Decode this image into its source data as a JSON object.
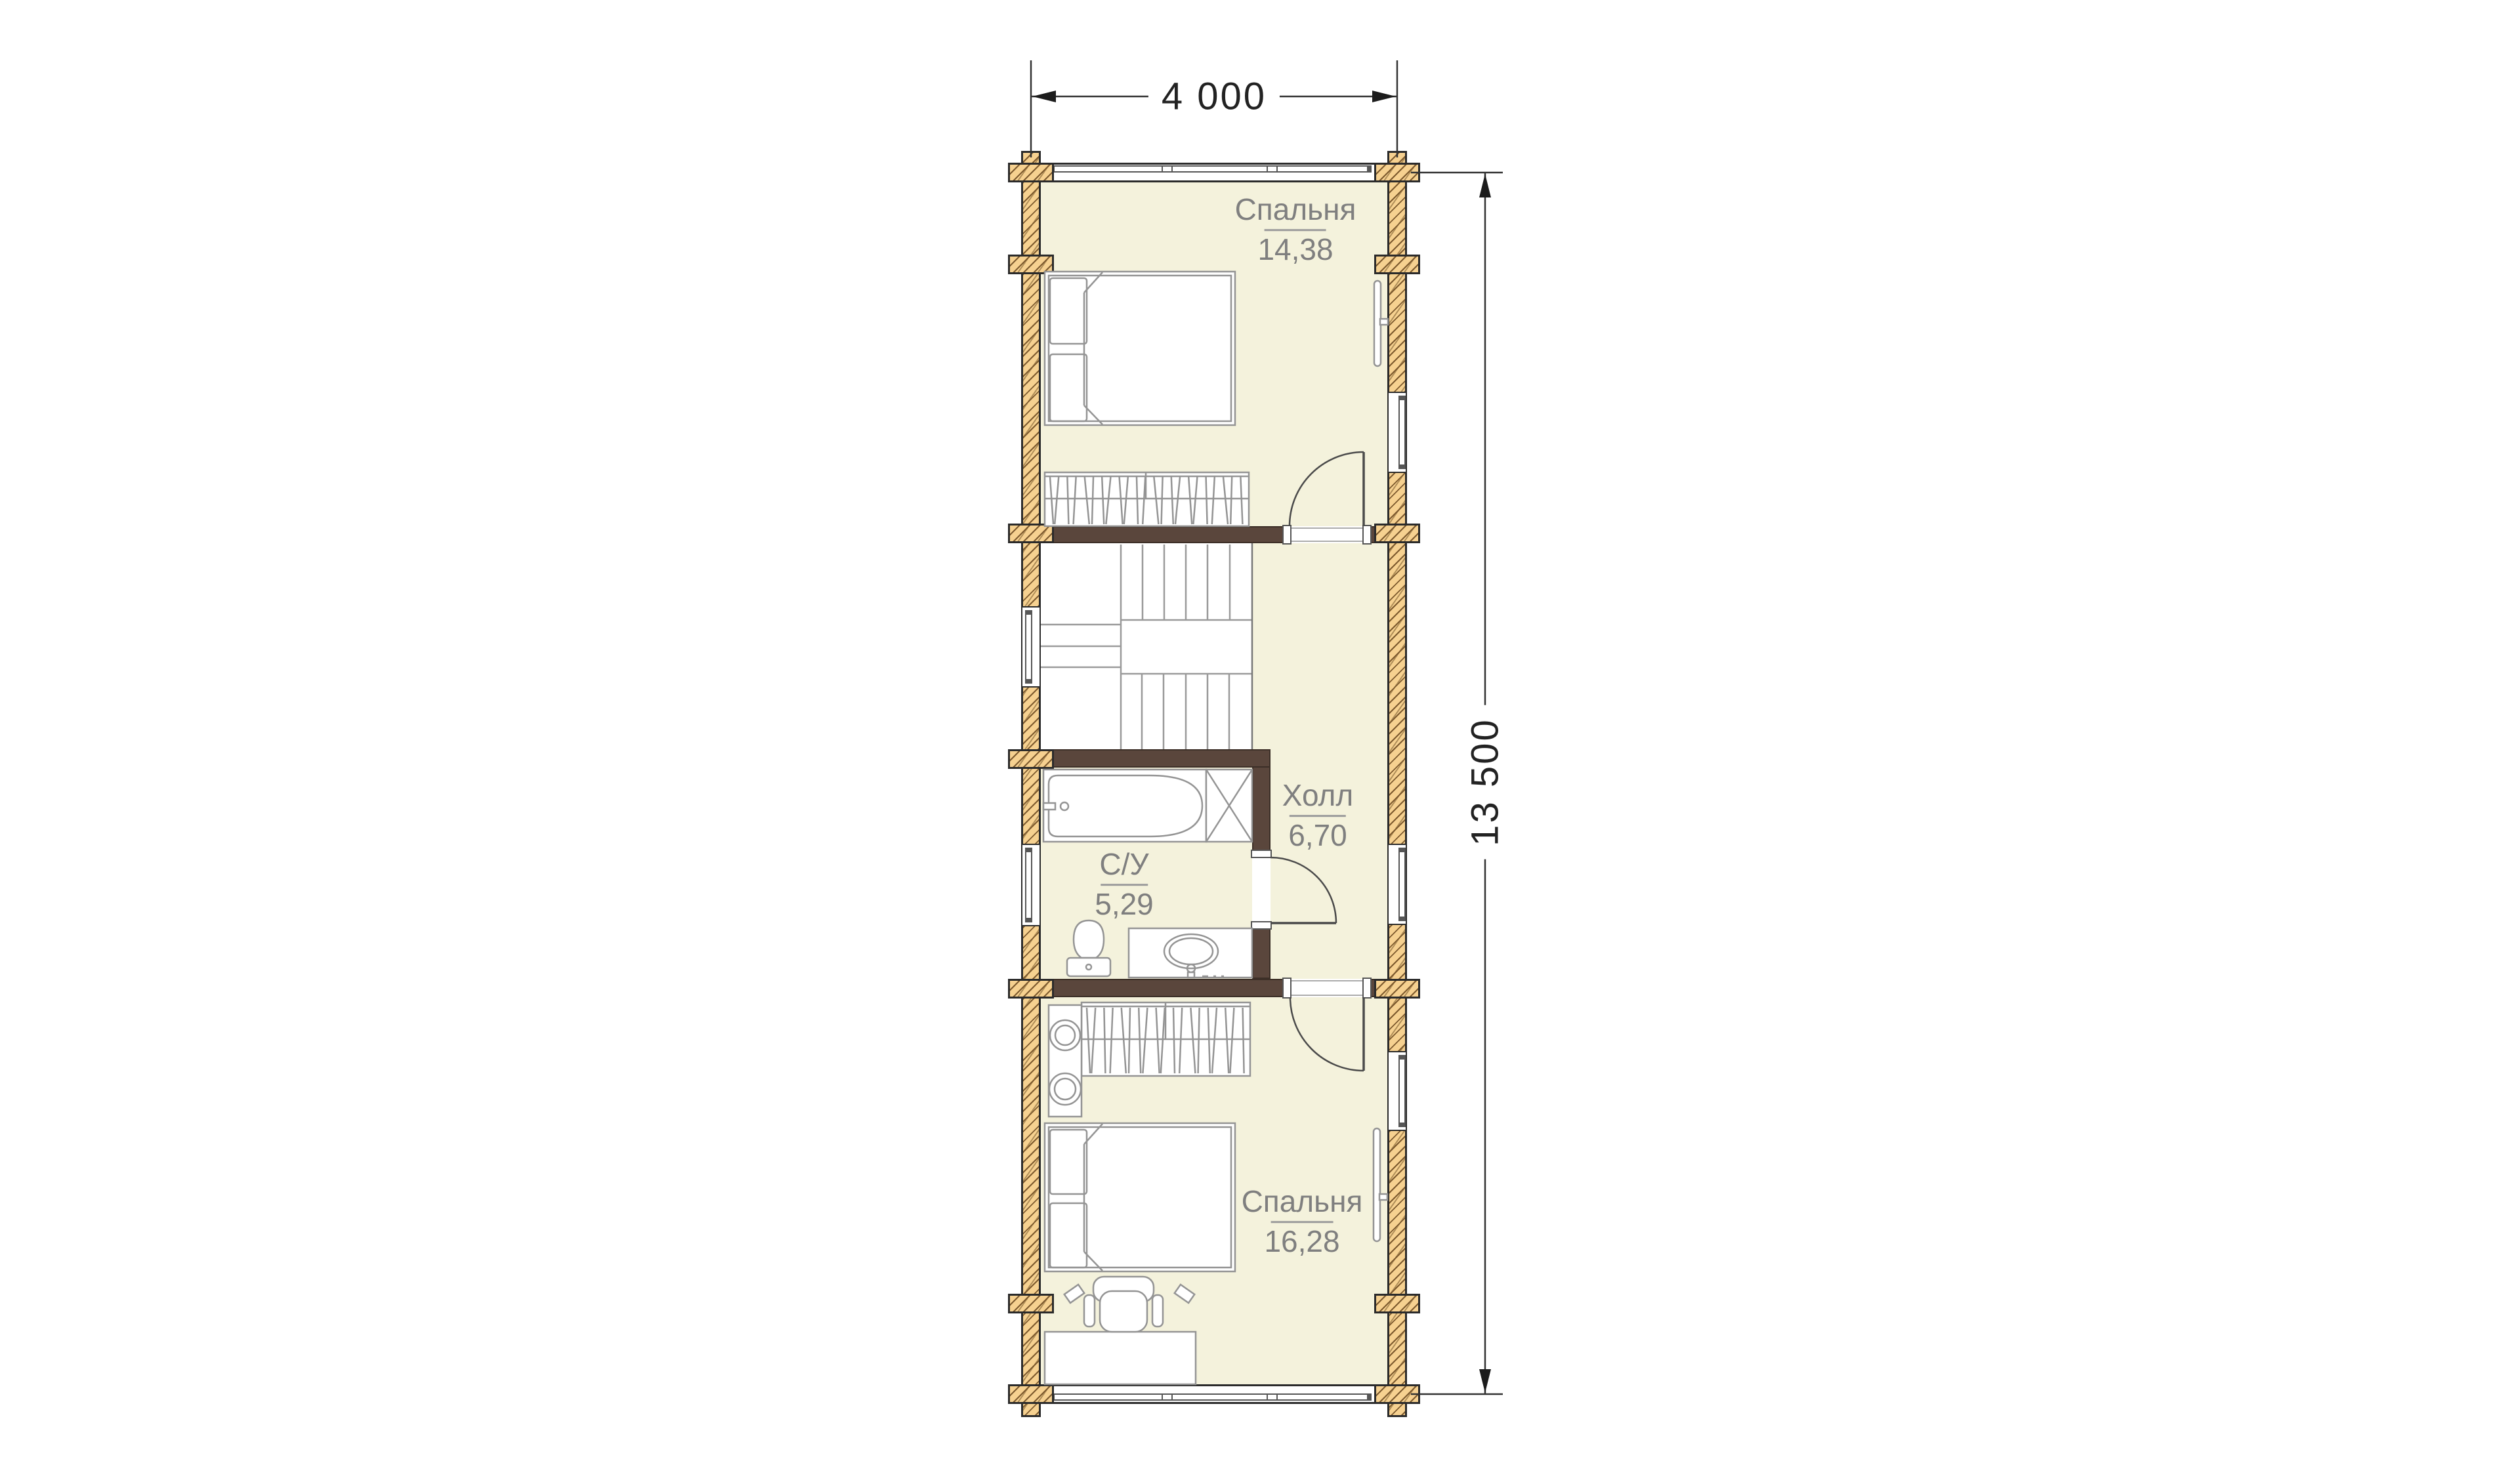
{
  "plan_title": "Second floor plan (log house)",
  "dimensions": {
    "width_label": "4 000",
    "height_label": "13 500"
  },
  "rooms": [
    {
      "id": "bedroom-top",
      "name": "Спальня",
      "area": "14,38"
    },
    {
      "id": "hall",
      "name": "Холл",
      "area": "6,70"
    },
    {
      "id": "bathroom",
      "name": "С/У",
      "area": "5,29"
    },
    {
      "id": "bedroom-bottom",
      "name": "Спальня",
      "area": "16,28"
    }
  ],
  "colors": {
    "room_fill": "#f4f2dc",
    "wood": "#f6d190",
    "wood_hatch": "#7d5a2e",
    "wall_brown": "#5a463c",
    "outline": "#2b2b2b",
    "furn": "#949494",
    "stair": "#9a9a9a",
    "door": "#4a4a4a",
    "label": "#7f7f7f",
    "dim": "#222222"
  }
}
